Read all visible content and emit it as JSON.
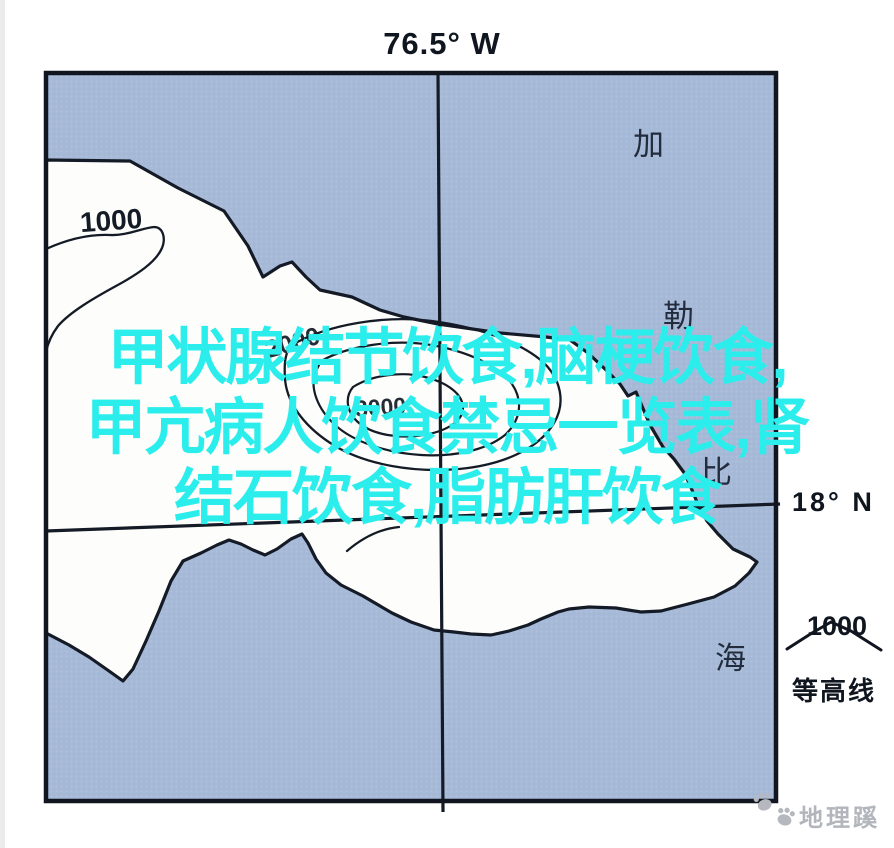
{
  "figure": {
    "longitude_label": "76.5° W",
    "latitude_label": "18° N",
    "sea_name": [
      "加",
      "勒",
      "比",
      "海"
    ],
    "contours": {
      "west_label": "1000",
      "outer_label": "2000",
      "inner_label": "3000"
    },
    "legend": {
      "value": "1000",
      "name": "等高线"
    },
    "brand_watermark": "地理蹊",
    "overlay_watermark": {
      "line1": "甲状腺结节饮食,脑梗饮食,",
      "line2": "甲亢病人饮食禁忌一览表,肾",
      "line3": "结石饮食,脂肪肝饮食"
    },
    "colors": {
      "sea": "#a6bad8",
      "land": "#fdfdfb",
      "ink": "#141b26",
      "overlay_text": "#2beeec",
      "brand_gray": "#b2b6bc"
    }
  }
}
